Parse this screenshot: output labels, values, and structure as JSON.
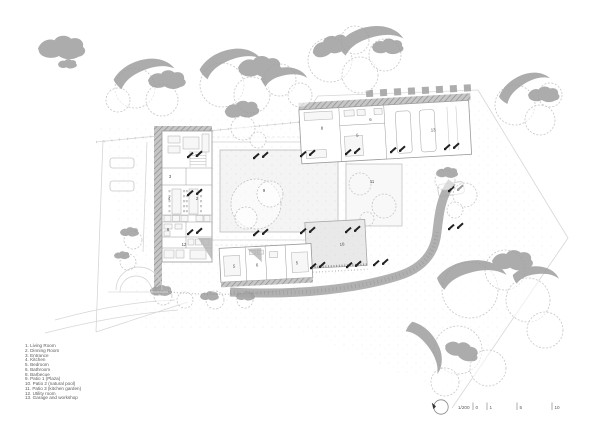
{
  "legend": {
    "items": [
      "1. Living Room",
      "2. Dinning Room",
      "3. Entrance",
      "4. Kitchen",
      "5. Bedroom",
      "6. Bathroom",
      "8. Barbecue",
      "9. Patio 1 (Plaza)",
      "10. Patio 2 (natural pool)",
      "11. Patio 3 (kitchen garden)",
      "12. Utility room",
      "13. Garage and workshop"
    ]
  },
  "plan": {
    "room_labels": [
      "1",
      "3",
      "4",
      "2",
      "6",
      "12",
      "8",
      "6",
      "5",
      "13",
      "5",
      "6",
      "5",
      "9",
      "10",
      "11"
    ]
  },
  "scalebar": {
    "scale_label": "1/200",
    "ticks": [
      "0",
      "1",
      "5",
      "10"
    ]
  },
  "colors": {
    "wall": "#9a9a9a",
    "tree_shadow": "#9d9d9d",
    "column": "#222222",
    "text": "#555555"
  }
}
